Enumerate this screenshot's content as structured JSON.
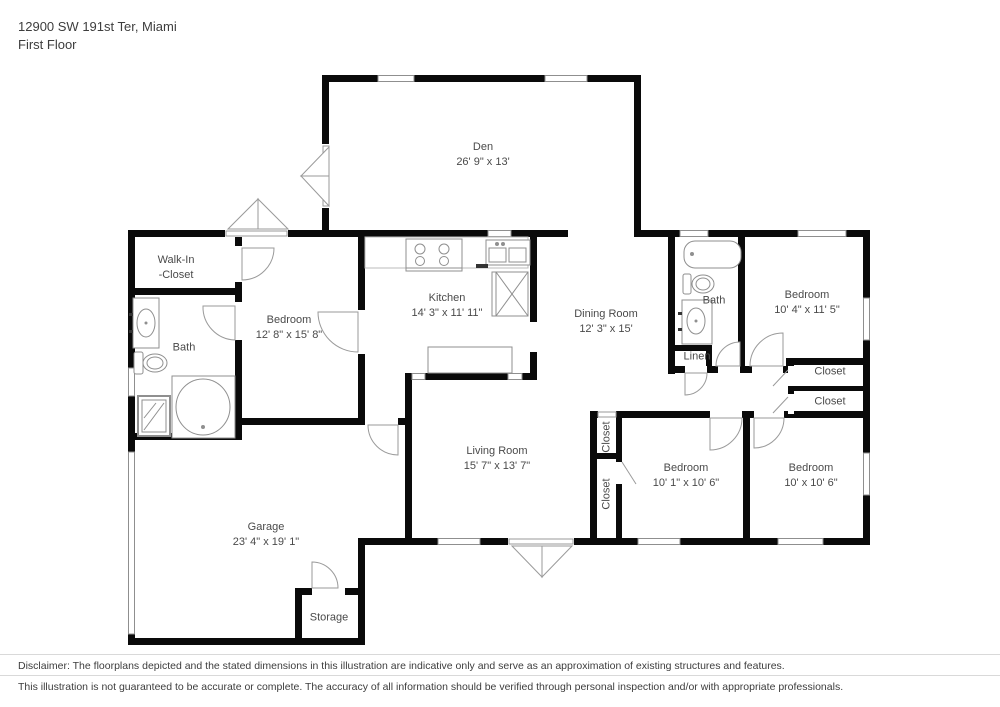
{
  "header": {
    "address": "12900 SW 191st Ter, Miami",
    "floor": "First Floor"
  },
  "rooms": [
    {
      "id": "den",
      "lines": [
        "Den",
        "26' 9\" x 13'"
      ]
    },
    {
      "id": "walkin_closet",
      "lines": [
        "Walk-In",
        "-Closet"
      ]
    },
    {
      "id": "bath_left",
      "lines": [
        "Bath"
      ]
    },
    {
      "id": "bedroom_left",
      "lines": [
        "Bedroom",
        "12' 8\" x 15' 8\""
      ]
    },
    {
      "id": "kitchen",
      "lines": [
        "Kitchen",
        "14' 3\" x 11' 11\""
      ]
    },
    {
      "id": "dining_room",
      "lines": [
        "Dining Room",
        "12' 3\" x 15'"
      ]
    },
    {
      "id": "bath_right",
      "lines": [
        "Bath"
      ]
    },
    {
      "id": "bedroom_top_right",
      "lines": [
        "Bedroom",
        "10' 4\" x 11' 5\""
      ]
    },
    {
      "id": "linen",
      "lines": [
        "Linen"
      ]
    },
    {
      "id": "closet_right_1",
      "lines": [
        "Closet"
      ]
    },
    {
      "id": "closet_right_2",
      "lines": [
        "Closet"
      ]
    },
    {
      "id": "living_room",
      "lines": [
        "Living Room",
        "15' 7\" x 13' 7\""
      ]
    },
    {
      "id": "closet_vert_1",
      "lines": [
        "Closet"
      ]
    },
    {
      "id": "closet_vert_2",
      "lines": [
        "Closet"
      ]
    },
    {
      "id": "bedroom_mid",
      "lines": [
        "Bedroom",
        "10' 1\" x 10' 6\""
      ]
    },
    {
      "id": "bedroom_bottom_right",
      "lines": [
        "Bedroom",
        "10' x 10' 6\""
      ]
    },
    {
      "id": "garage",
      "lines": [
        "Garage",
        "23' 4\" x 19' 1\""
      ]
    },
    {
      "id": "storage",
      "lines": [
        "Storage"
      ]
    }
  ],
  "footer": {
    "line1": "Disclaimer: The floorplans depicted and the stated dimensions in this illustration are indicative only and serve as an approximation of existing structures and features.",
    "line2": "This illustration is not guaranteed to be accurate or complete. The accuracy of all information should be verified through personal inspection and/or with appropriate professionals."
  },
  "colors": {
    "wall": "#0a0a0a",
    "fixture_stroke": "#8f8f8f",
    "text": "#4a4a4a",
    "divider": "#d9d9d9"
  }
}
